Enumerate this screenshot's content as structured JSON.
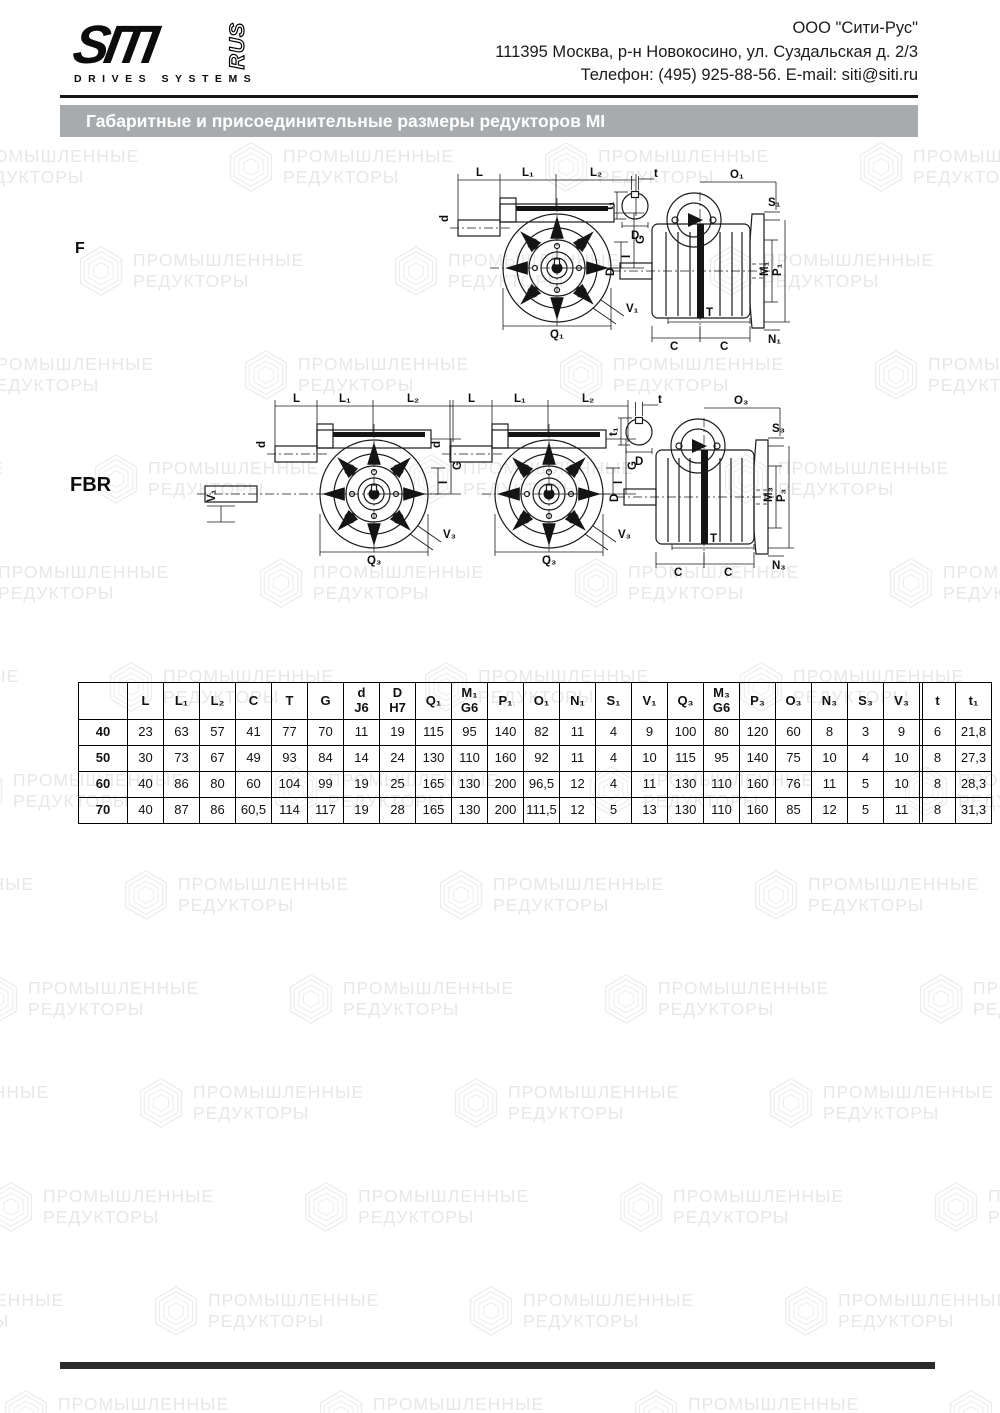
{
  "header": {
    "logo_main": "SITI",
    "logo_sub": "RUS",
    "logo_tagline": "DRIVES SYSTEMS",
    "company_line1": "ООО \"Сити-Рус\"",
    "company_line2": "111395 Москва, р-н Новокосино, ул. Суздальская д. 2/3",
    "company_line3": "Телефон: (495) 925-88-56. E-mail: siti@siti.ru"
  },
  "title_bar": {
    "text": "Габаритные и присоединительные размеры редукторов MI"
  },
  "watermark": {
    "line1": "ПРОМЫШЛЕННЫЕ",
    "line2": "РЕДУКТОРЫ"
  },
  "drawings": {
    "f_label": "F",
    "fbr_label": "FBR",
    "front_dims": {
      "L": "L",
      "L1": "L₁",
      "L2": "L₂",
      "d": "d",
      "G": "G",
      "I": "I"
    },
    "f_front": {
      "Q": "Q₁",
      "V": "V₁"
    },
    "fbr_front": {
      "Q": "Q₃",
      "V": "V₃",
      "V_left": "V₁"
    },
    "key_detail": {
      "t": "t",
      "t1": "t₁",
      "D": "D"
    },
    "f_side": {
      "O": "O₁",
      "S": "S₁",
      "M": "M₁",
      "P": "P₁",
      "N": "N₁",
      "D": "D",
      "T": "T",
      "C": "C"
    },
    "fbr_side": {
      "O": "O₃",
      "S": "S₃",
      "M": "M₃",
      "P": "P₃",
      "N": "N₃",
      "D": "D",
      "T": "T",
      "C": "C"
    }
  },
  "table": {
    "headers": [
      "",
      "L",
      "L₁",
      "L₂",
      "C",
      "T",
      "G",
      "d\nJ6",
      "D\nH7",
      "Q₁",
      "M₁\nG6",
      "P₁",
      "O₁",
      "N₁",
      "S₁",
      "V₁",
      "Q₃",
      "M₃\nG6",
      "P₃",
      "O₃",
      "N₃",
      "S₃",
      "V₃",
      "t",
      "t₁"
    ],
    "rows": [
      [
        "40",
        "23",
        "63",
        "57",
        "41",
        "77",
        "70",
        "11",
        "19",
        "115",
        "95",
        "140",
        "82",
        "11",
        "4",
        "9",
        "100",
        "80",
        "120",
        "60",
        "8",
        "3",
        "9",
        "6",
        "21,8"
      ],
      [
        "50",
        "30",
        "73",
        "67",
        "49",
        "93",
        "84",
        "14",
        "24",
        "130",
        "110",
        "160",
        "92",
        "11",
        "4",
        "10",
        "115",
        "95",
        "140",
        "75",
        "10",
        "4",
        "10",
        "8",
        "27,3"
      ],
      [
        "60",
        "40",
        "86",
        "80",
        "60",
        "104",
        "99",
        "19",
        "25",
        "165",
        "130",
        "200",
        "96,5",
        "12",
        "4",
        "11",
        "130",
        "110",
        "160",
        "76",
        "11",
        "5",
        "10",
        "8",
        "28,3"
      ],
      [
        "70",
        "40",
        "87",
        "86",
        "60,5",
        "114",
        "117",
        "19",
        "28",
        "165",
        "130",
        "200",
        "111,5",
        "12",
        "5",
        "13",
        "130",
        "110",
        "160",
        "85",
        "12",
        "5",
        "11",
        "8",
        "31,3"
      ]
    ]
  },
  "colors": {
    "title_bar_bg": "#a7abad",
    "title_text": "#ffffff",
    "footer_bar": "#2b2b2b",
    "watermark": "#e7e7e7",
    "line": "#1a1a1a"
  }
}
